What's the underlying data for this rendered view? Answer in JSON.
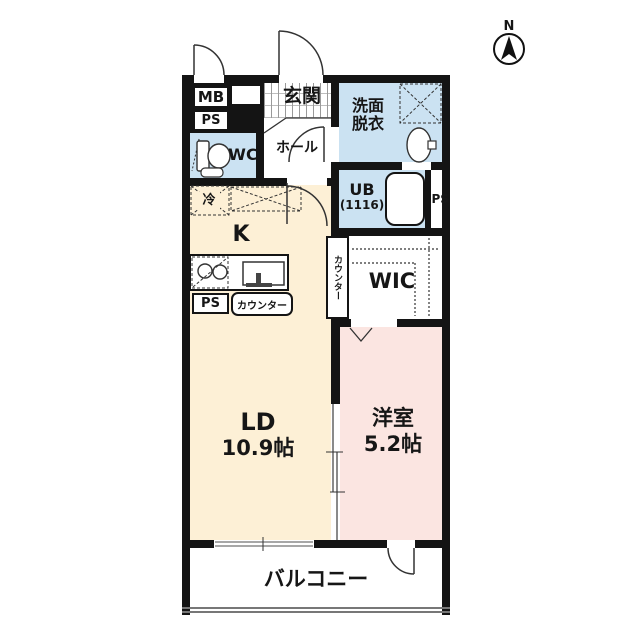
{
  "title": "floor-plan",
  "colors": {
    "wall": "#141414",
    "wet_room_fill": "#cbe2f2",
    "living_fill": "#fdf0d6",
    "bedroom_fill": "#fbe5e1",
    "outline_gray": "#8a8a8a"
  },
  "compass": {
    "north_label": "N"
  },
  "rooms": {
    "entrance": {
      "label": "玄関"
    },
    "hall": {
      "label": "ホール"
    },
    "wc": {
      "label": "WC"
    },
    "washroom": {
      "label": "洗面\n脱衣"
    },
    "bath": {
      "label": "UB",
      "size": "(1116)"
    },
    "kitchen": {
      "label": "K"
    },
    "living_dining": {
      "label": "LD",
      "size": "10.9帖"
    },
    "western_room": {
      "label": "洋室",
      "size": "5.2帖"
    },
    "walk_in_closet": {
      "label": "WIC"
    },
    "balcony": {
      "label": "バルコニー"
    }
  },
  "fixtures": {
    "meter_box": {
      "label": "MB"
    },
    "pipe_shaft_entrance": {
      "label": "PS"
    },
    "pipe_shaft_kitchen": {
      "label": "PS"
    },
    "pipe_shaft_bath": {
      "label": "PS"
    },
    "refrigerator": {
      "label": "冷"
    },
    "kitchen_counter": {
      "label": "カウンター"
    },
    "ld_side_counter": {
      "label": "カウンター"
    }
  }
}
